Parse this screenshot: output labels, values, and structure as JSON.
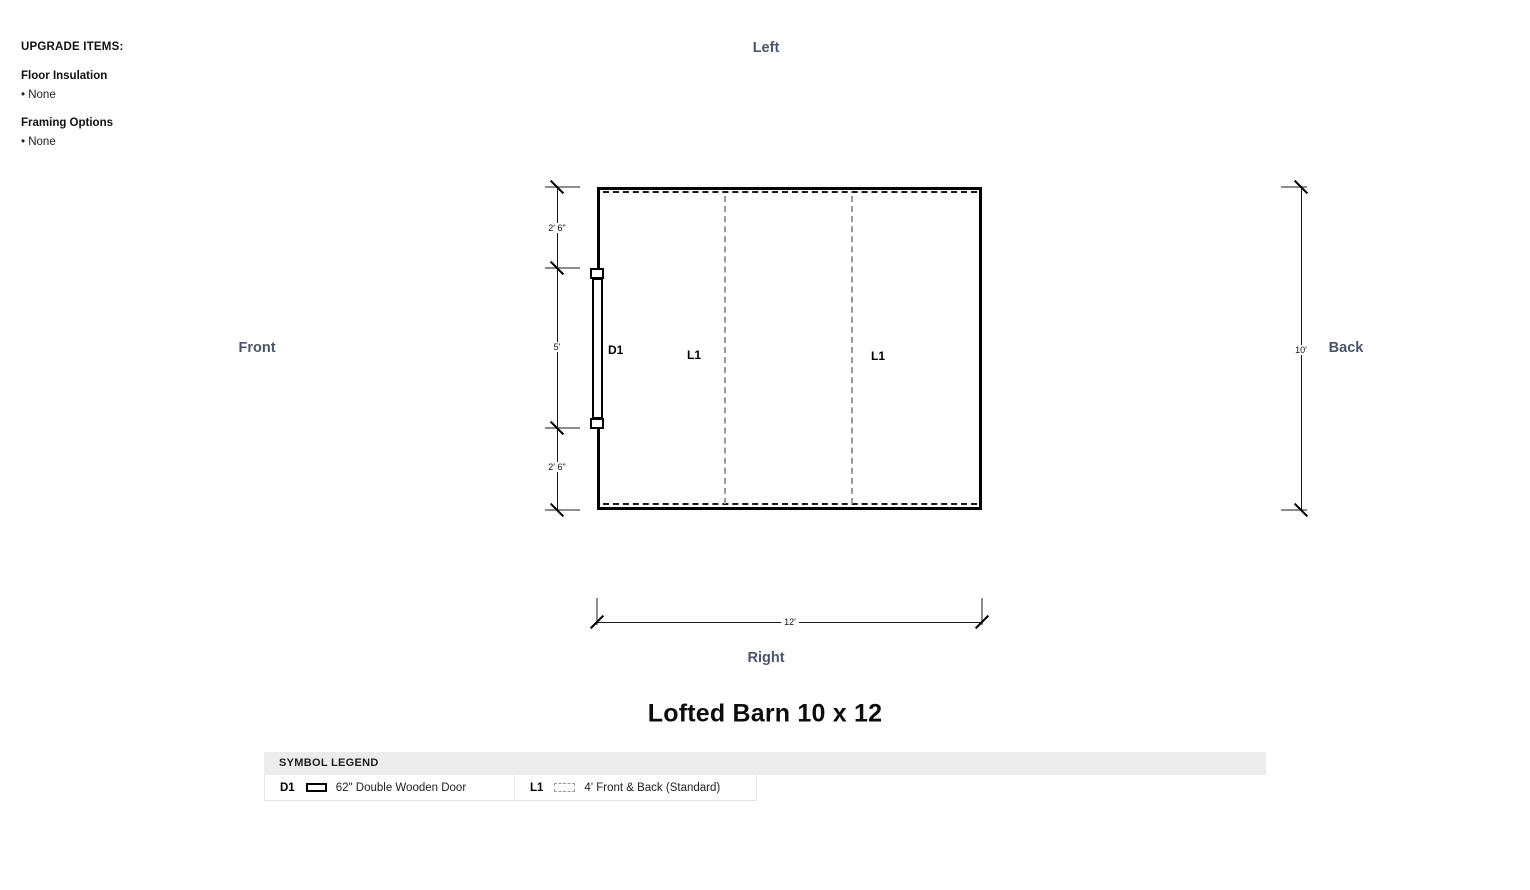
{
  "upgrade_panel": {
    "title": "UPGRADE ITEMS:",
    "sections": [
      {
        "heading": "Floor Insulation",
        "value": "• None"
      },
      {
        "heading": "Framing Options",
        "value": "• None"
      }
    ]
  },
  "plan": {
    "orientation": {
      "top": "Left",
      "left": "Front",
      "right": "Back",
      "bottom": "Right"
    },
    "symbols": {
      "door": "D1",
      "loft_front": "L1",
      "loft_back": "L1"
    },
    "dimensions": {
      "left_segments": [
        "2' 6\"",
        "5'",
        "2' 6\""
      ],
      "right_total": "10'",
      "bottom_total": "12'"
    }
  },
  "title": "Lofted Barn 10 x 12",
  "legend": {
    "header": "SYMBOL LEGEND",
    "items": [
      {
        "code": "D1",
        "icon": "door-icon",
        "label": "62\" Double Wooden Door"
      },
      {
        "code": "L1",
        "icon": "loft-icon",
        "label": "4' Front & Back (Standard)"
      }
    ]
  },
  "colors": {
    "direction_label": "#4b5568",
    "wall": "#000000",
    "loft_dashed": "#9a9a9a",
    "legend_header_bg": "#ececec"
  }
}
